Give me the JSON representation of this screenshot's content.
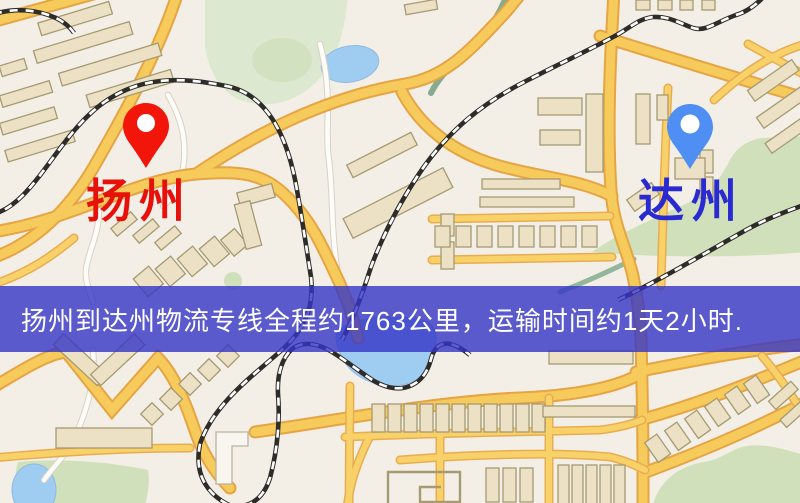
{
  "banner": {
    "text": "扬州到达州物流专线全程约1763公里，运输时间约1天2小时.",
    "background_color": "#3434c7",
    "text_color": "#ffffff"
  },
  "markers": {
    "origin": {
      "label": "扬州",
      "label_color": "#e8100a",
      "pin_color": "#f2150a",
      "pin_icon": "red-map-pin"
    },
    "destination": {
      "label": "达州",
      "label_color": "#2a2ad2",
      "pin_color": "#4f8ff4",
      "pin_icon": "blue-map-pin"
    }
  },
  "route": {
    "origin_city": "扬州",
    "destination_city": "达州",
    "service": "物流专线",
    "distance_text": "约1763公里",
    "duration_text": "约1天2小时"
  },
  "map_palette": {
    "background": "#f4efe6",
    "road": "#f7ca5c",
    "road_casing": "#e5a544",
    "water": "#9fccf1",
    "park": "#cfe0bb",
    "railway": "#2e2c29",
    "building": "#ece1c4"
  }
}
